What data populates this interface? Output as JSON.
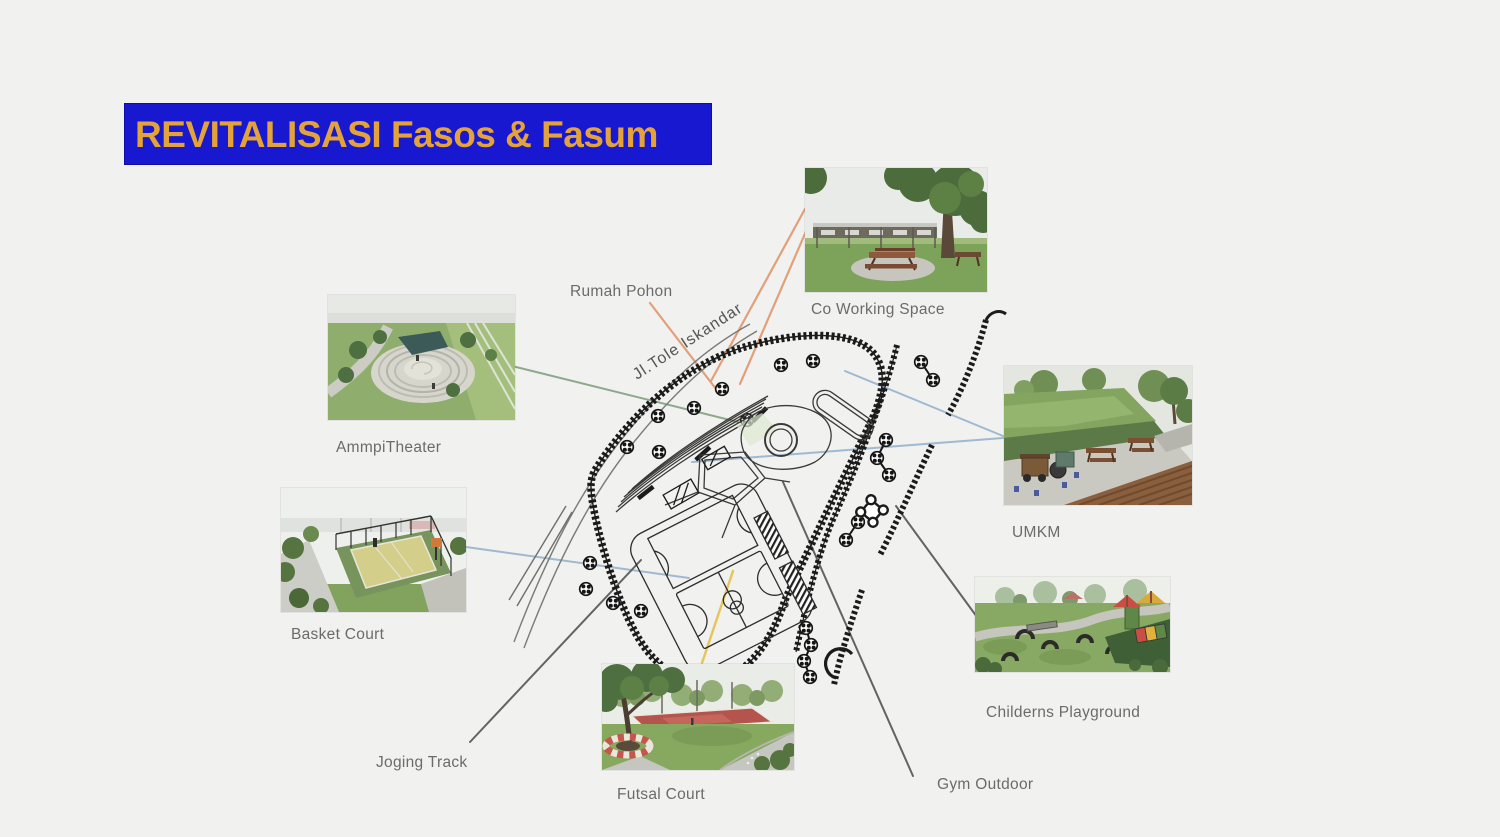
{
  "slide": {
    "background_color": "#f1f1ef",
    "title": {
      "text": "REVITALISASI Fasos & Fasum",
      "bg_color": "#1818D0",
      "text_color": "#E3A338"
    }
  },
  "plan": {
    "street_label": "Jl.Tole  Iskandar",
    "line_color": "#1b1b1b"
  },
  "callouts": {
    "rumah_pohon": {
      "label": "Rumah Pohon",
      "connector_color": "#E2A07A",
      "has_photo": false
    },
    "co_working_space": {
      "label": "Co Working Space",
      "connector_color": "#E2A07A",
      "has_photo": true
    },
    "ammpi_theater": {
      "label": "AmmpiTheater",
      "connector_color": "#8CA98C",
      "has_photo": true
    },
    "umkm": {
      "label": "UMKM",
      "connector_color": "#9FB9D0",
      "has_photo": true
    },
    "basket_court": {
      "label": "Basket Court",
      "connector_color": "#9FB9D0",
      "has_photo": true
    },
    "childerns_playground": {
      "label": "Childerns Playground",
      "connector_color": "#636363",
      "has_photo": true
    },
    "joging_track": {
      "label": "Joging Track",
      "connector_color": "#636363",
      "has_photo": false
    },
    "futsal_court": {
      "label": "Futsal Court",
      "connector_color": "#E5C55E",
      "has_photo": true
    },
    "gym_outdoor": {
      "label": "Gym Outdoor",
      "connector_color": "#636363",
      "has_photo": false
    }
  }
}
